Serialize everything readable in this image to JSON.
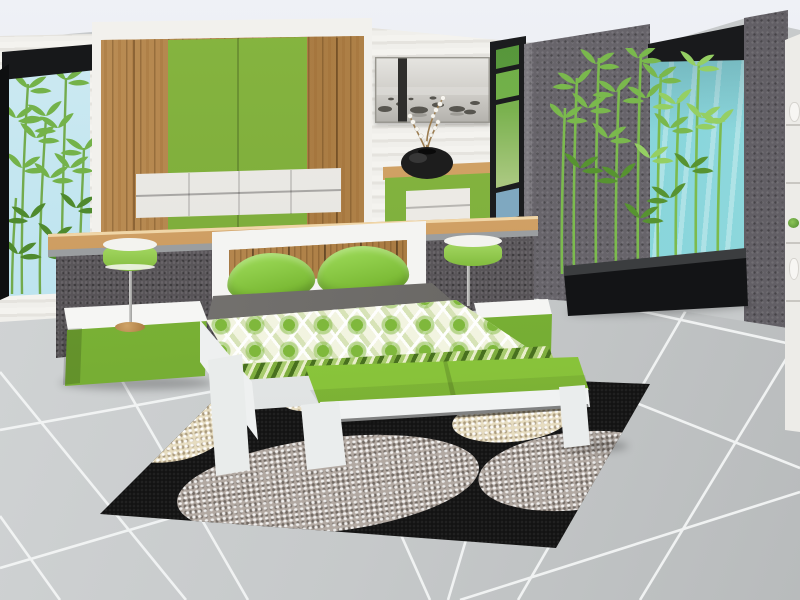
{
  "watermark": {
    "text": "by Joy"
  },
  "colors": {
    "accent-green": "#8cc63f",
    "green-dark": "#6fa32c",
    "wood": "#b9894f",
    "wood-light": "#d8a96c",
    "wall-white": "#efeeea",
    "wall-gray": "#67646a",
    "half-wall-gray": "#5b575b",
    "floor-tile": "#c7cacb",
    "grout-white": "#f3f5f5",
    "rug-black": "#131313",
    "rug-cream": "#e6dcc0",
    "rug-gray": "#b2a9a2",
    "window-teal": "#8ed9de",
    "sky-blue": "#c2e6f0",
    "bamboo-green": "#6fa845",
    "bedding-gray": "#6b6a68",
    "vase-black": "#1d1d1d",
    "ceiling": "#e7eaf0",
    "watermark-color": "#1c1c1c"
  },
  "objects": [
    {
      "id": "wardrobe",
      "label": "wood and green wardrobe with white drawer band"
    },
    {
      "id": "wall-art",
      "label": "grayscale seascape wall art"
    },
    {
      "id": "orchid-vase",
      "label": "black round vase with white orchid"
    },
    {
      "id": "dresser",
      "label": "green dresser with white drawers"
    },
    {
      "id": "left-window",
      "label": "tall window with bamboo"
    },
    {
      "id": "narrow-window",
      "label": "narrow window with outdoor view"
    },
    {
      "id": "right-window",
      "label": "teal glass window"
    },
    {
      "id": "bamboo-planter",
      "label": "black bamboo planter box"
    },
    {
      "id": "room-divider",
      "label": "gray half wall with wood rail"
    },
    {
      "id": "bed",
      "label": "white double bed with green diamond quilt and pillows"
    },
    {
      "id": "bench",
      "label": "white bench with green cushion"
    },
    {
      "id": "nightstand-left",
      "label": "left nightstand"
    },
    {
      "id": "nightstand-right",
      "label": "right nightstand"
    },
    {
      "id": "table-lamp-left",
      "label": "green drum table lamp"
    },
    {
      "id": "table-lamp-right",
      "label": "green drum table lamp"
    },
    {
      "id": "pebble-rug",
      "label": "black rug with pebble circles"
    },
    {
      "id": "display-shelf",
      "label": "white display shelf with vases"
    },
    {
      "id": "tile-floor",
      "label": "gray tile floor with diagonal grout"
    }
  ]
}
